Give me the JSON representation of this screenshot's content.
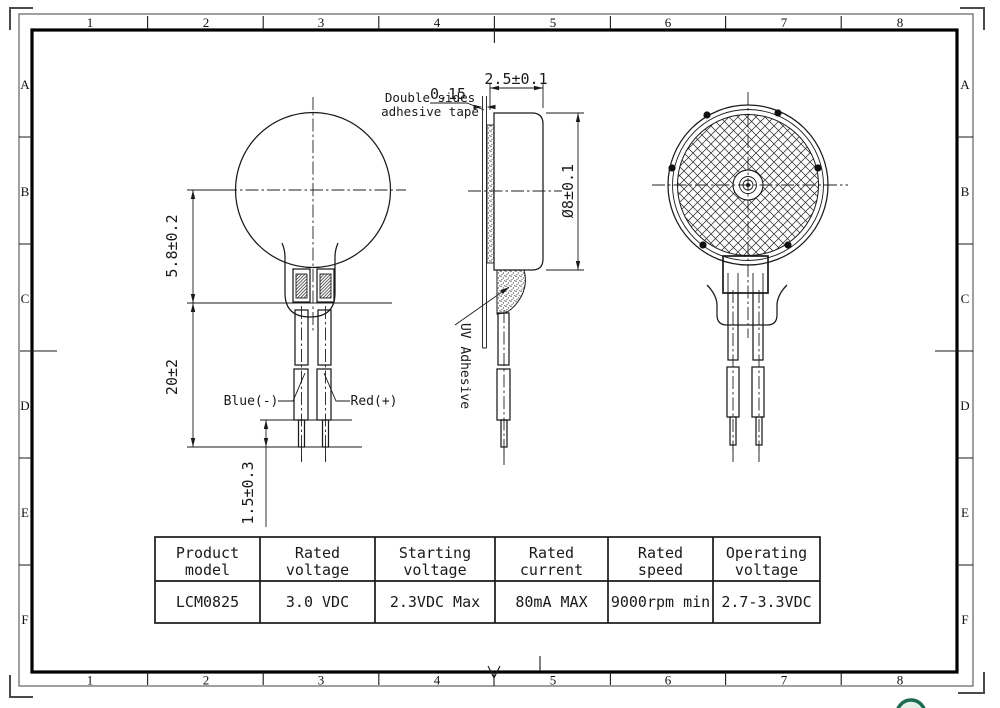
{
  "drawing": {
    "type": "engineering-drawing",
    "product": "coin vibration motor"
  },
  "frame": {
    "columns": [
      "1",
      "2",
      "3",
      "4",
      "5",
      "6",
      "7",
      "8"
    ],
    "rows": [
      "A",
      "B",
      "C",
      "D",
      "E",
      "F"
    ]
  },
  "front_view": {
    "dim_body_height": "5.8±0.2",
    "dim_lead_length": "20±2",
    "dim_tip_length": "1.5±0.3",
    "label_blue": "Blue(-)",
    "label_red": "Red(+)"
  },
  "side_view": {
    "dim_thickness": "2.5±0.1",
    "dim_tape_thickness": "0.15",
    "dim_diameter": "Ø8±0.1",
    "tape_label_line1": "Double sides",
    "tape_label_line2": "adhesive tape",
    "uv_label": "UV Adhesive"
  },
  "spec_table": {
    "headers": [
      [
        "Product",
        "model"
      ],
      [
        "Rated",
        "voltage"
      ],
      [
        "Starting",
        "voltage"
      ],
      [
        "Rated",
        "current"
      ],
      [
        "Rated",
        "speed"
      ],
      [
        "Operating",
        "voltage"
      ]
    ],
    "row": [
      "LCM0825",
      "3.0 VDC",
      "2.3VDC Max",
      "80mA MAX",
      "9000rpm min",
      "2.7-3.3VDC"
    ]
  },
  "colors": {
    "line": "#1a1a1a",
    "frame_thin": "#606060",
    "logo_green": "#1b6b4f"
  }
}
